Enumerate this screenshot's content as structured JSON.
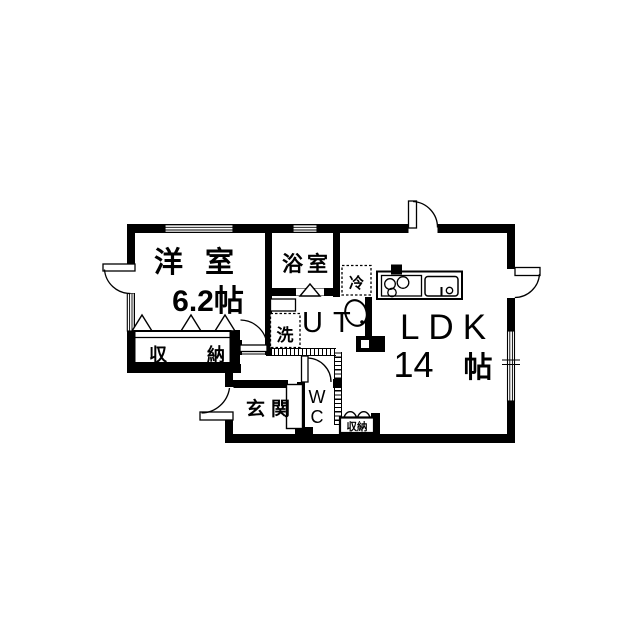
{
  "colors": {
    "line": "#000000",
    "background": "#ffffff"
  },
  "rooms": {
    "western": {
      "label": "洋室",
      "area": "6.2帖"
    },
    "bath": {
      "label": "浴室"
    },
    "utility": {
      "label": "UT"
    },
    "ldk": {
      "label": "LDK",
      "area_value": "14",
      "area_unit": "帖"
    },
    "entrance": {
      "label": "玄関"
    },
    "wc": {
      "line1": "W",
      "line2": "C"
    },
    "closet": {
      "label": "収納"
    },
    "small_closet": {
      "label": "収納"
    }
  },
  "fixtures": {
    "fridge": {
      "label": "冷"
    },
    "washer": {
      "label": "洗"
    }
  }
}
